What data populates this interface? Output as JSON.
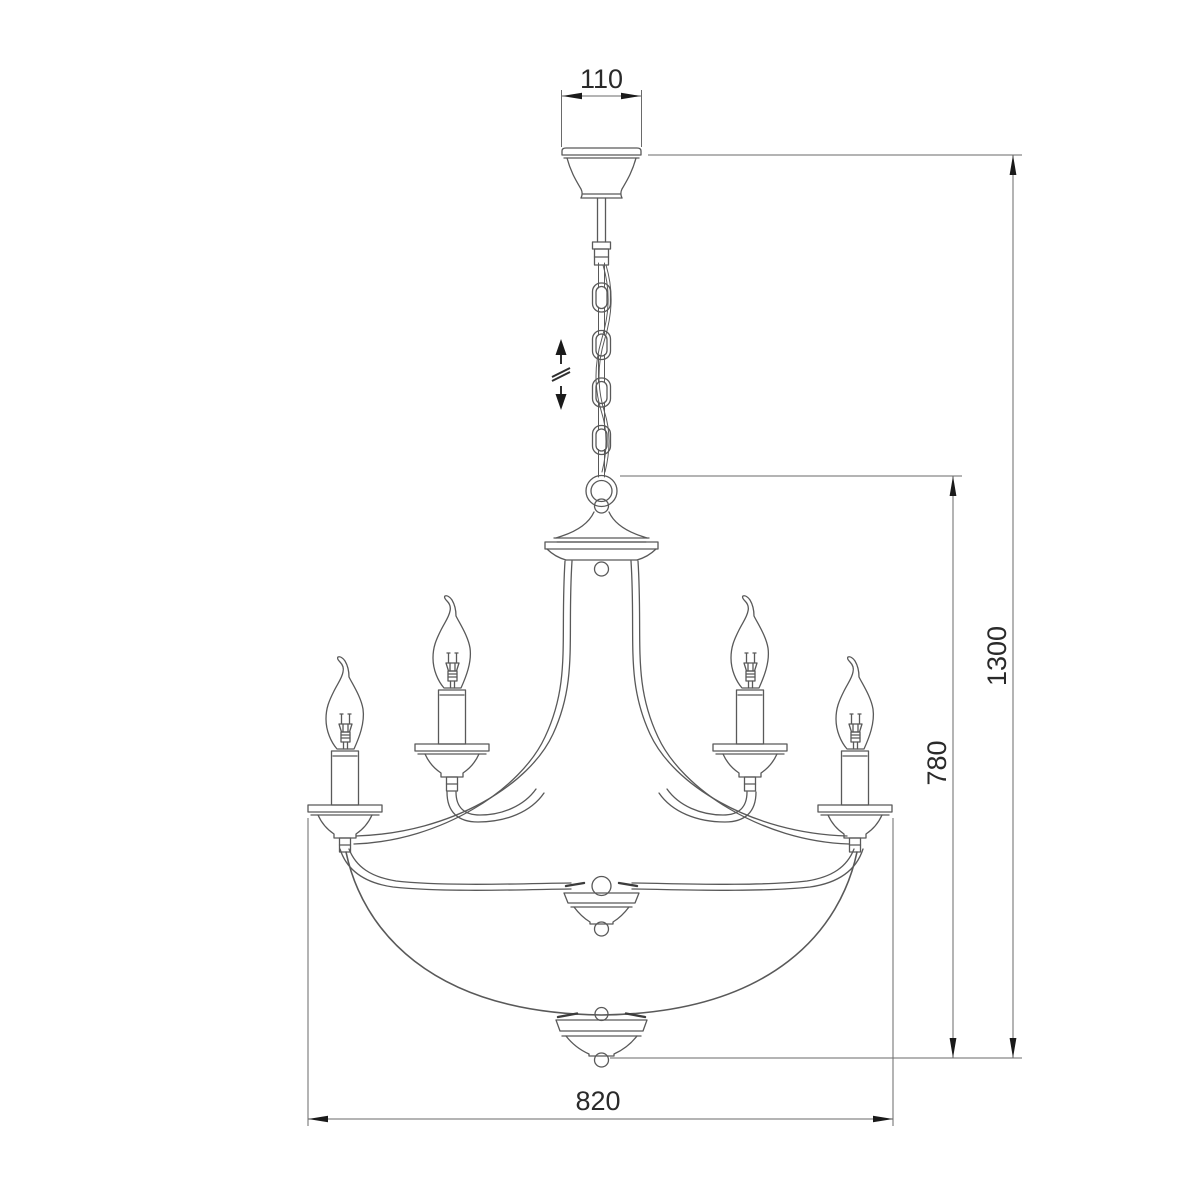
{
  "diagram": {
    "subject": "chandelier-dimensional-drawing",
    "dimensions": {
      "canopy_width": {
        "label": "110"
      },
      "overall_height": {
        "label": "1300"
      },
      "body_height": {
        "label": "780"
      },
      "body_width": {
        "label": "820"
      }
    },
    "symbols": {
      "height_adjustment": "double-arrow-with-break"
    },
    "style": {
      "background": "#ffffff",
      "figure_line": "#595959",
      "dimension_line": "#6a6a6a",
      "arrow_fill": "#1a1a1a",
      "text_color": "#2a2a2a"
    }
  }
}
